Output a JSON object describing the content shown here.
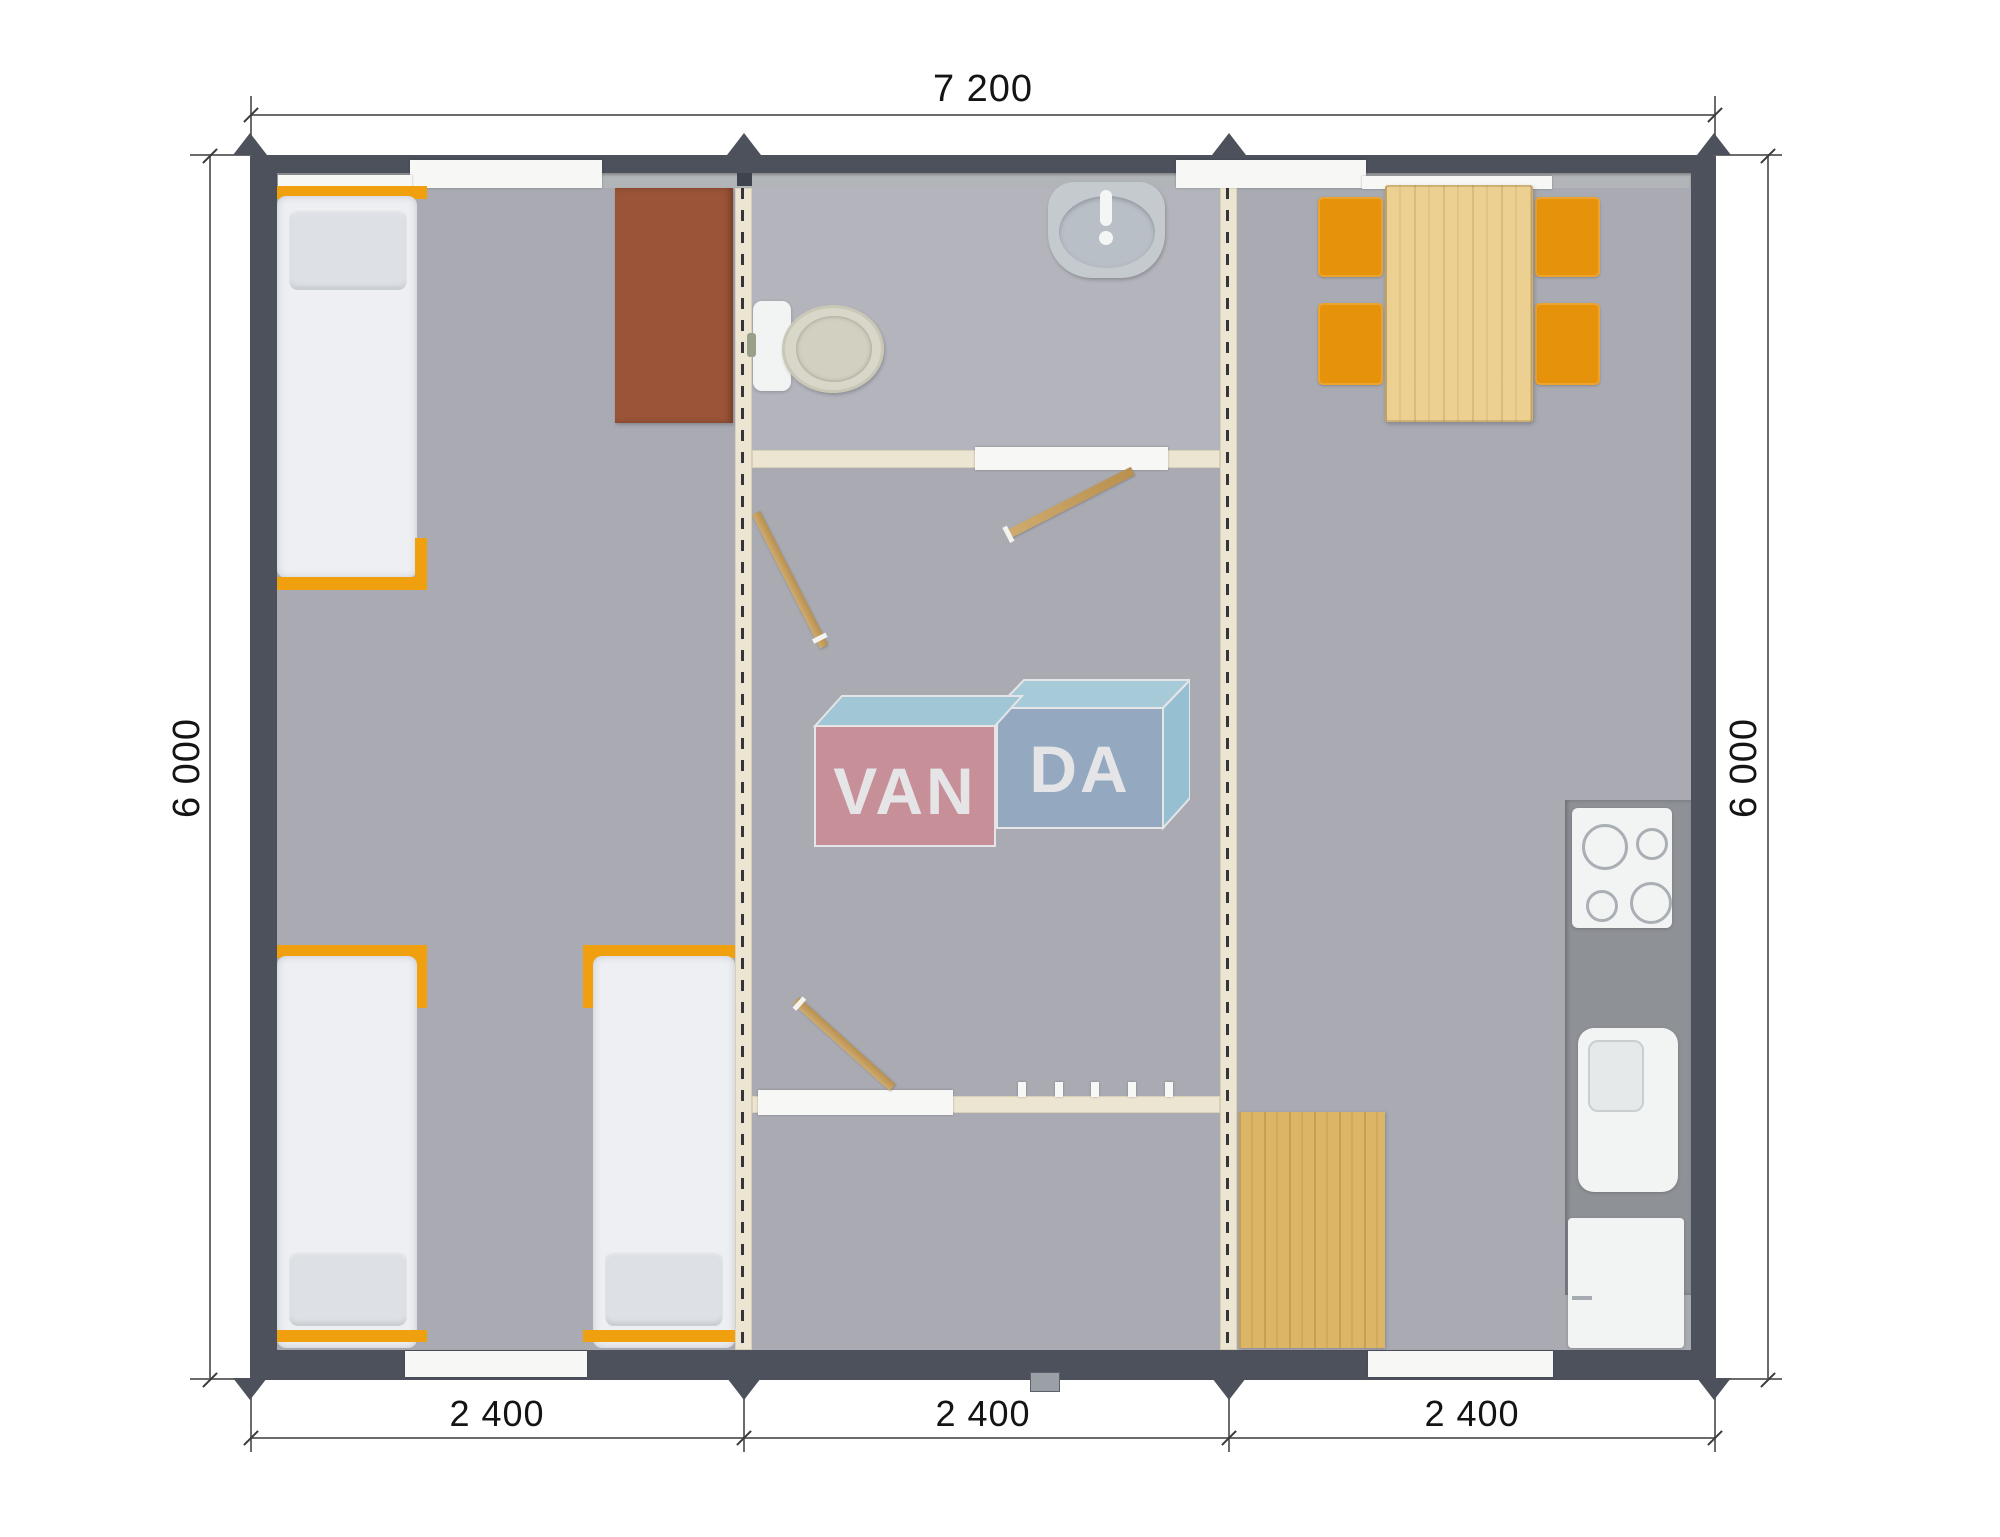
{
  "page": {
    "type": "architectural-floor-plan",
    "background": "#ffffff"
  },
  "dimensions": {
    "top_width": "7 200",
    "left_height": "6 000",
    "right_height": "6 000",
    "bottom_modules": [
      "2 400",
      "2 400",
      "2 400"
    ]
  },
  "logo": {
    "name": "VANDA",
    "text_left": "VAN",
    "text_right": "DA",
    "colors": {
      "left_box": "#d5868f",
      "right_box": "#8ca8c7",
      "top_faces": "#9ed3e5",
      "text": "#ffffff"
    }
  },
  "palette": {
    "wall_dark": "#4c515c",
    "wall_lining": "#b2b5b8",
    "floor_carpet": "#a9aab2",
    "module_wall_cream": "#ece5d1",
    "bed_frame_orange": "#f0a00e",
    "chair_orange": "#e6930b",
    "table_wood": "#ebd092",
    "mat_wood": "#ddb566",
    "desk_brown": "#9b5438",
    "fixture_white": "#f2f4f4",
    "counter_grey": "#8e9196"
  },
  "modules": [
    {
      "name": "bedroom-module",
      "furniture": [
        "single-bed",
        "single-bed",
        "single-bed",
        "desk"
      ]
    },
    {
      "name": "sanitary-module",
      "furniture": [
        "toilet",
        "wash-basin",
        "partition-wall",
        "partition-wall",
        "door",
        "door",
        "door"
      ]
    },
    {
      "name": "kitchen-module",
      "furniture": [
        "dining-table",
        "chair",
        "chair",
        "chair",
        "chair",
        "kitchen-counter",
        "cooktop",
        "kitchen-sink",
        "fridge",
        "wood-floor-mat"
      ]
    }
  ]
}
